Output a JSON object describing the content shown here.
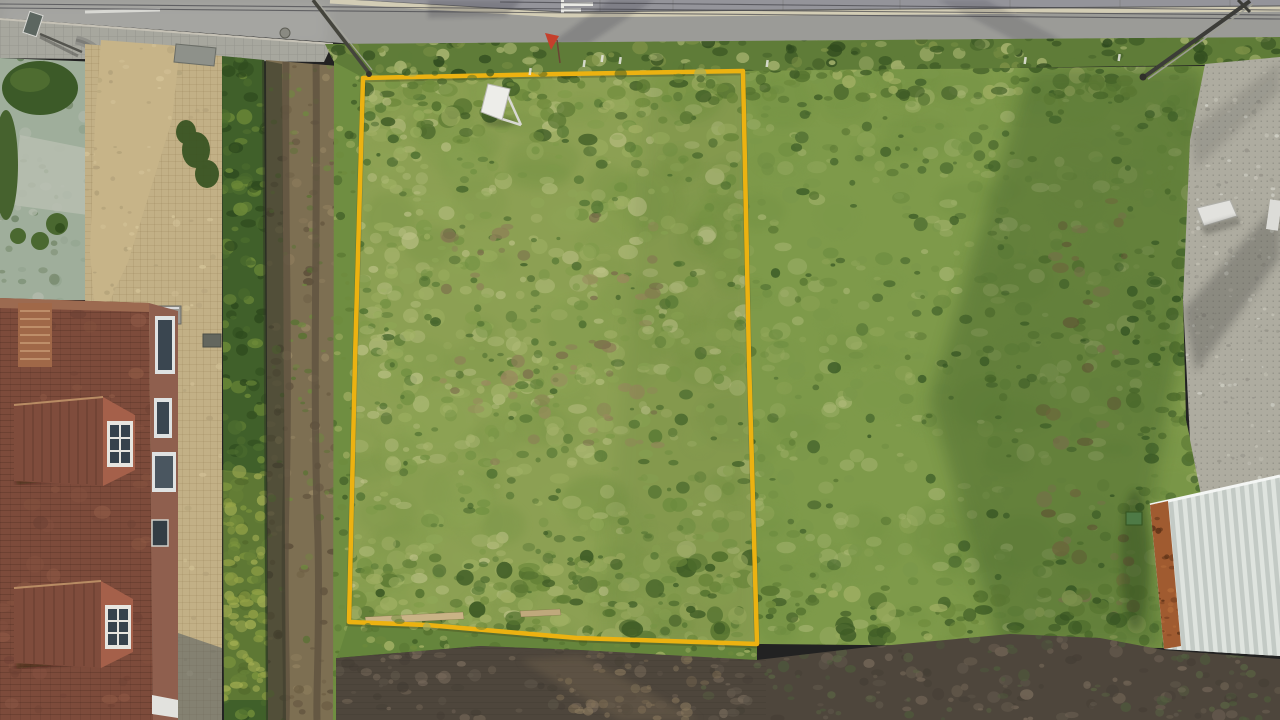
{
  "meta": {
    "type": "aerial-drone-photograph",
    "subject": "grass building plot outlined with a yellow boundary, road at top, house with red tiled roof at left, neighbouring grass field and white barn roof at right, dark ploughed field at bottom",
    "visible_text": "none"
  },
  "palette": {
    "boundary": "#ECB211",
    "asphalt": "#9B9B97",
    "far_sidewalk": "#94949A",
    "curb": "#D3CDB5",
    "sidewalk": "#A7A79E",
    "verge": "#5F7C38",
    "parcel": "#8CA053",
    "neighbor": "#7E9A4A",
    "hedge": "#40602A",
    "hedge_shadow": "#2F3524",
    "track": "#7D6F52",
    "grass_strip": "#6F8E41",
    "garden": "#9FAE9B",
    "garden_hedge": "#3C5A28",
    "driveway": "#C7B488",
    "courtyard": "#C2B086",
    "roof": "#7D4B3B",
    "roof_lit": "#A06848",
    "facade": "#8F5F4E",
    "field": "#4E463C",
    "field_verge": "#65853C",
    "pavers": "#AEACA0",
    "barn_roof": "#D0D5D0",
    "barn_rust": "#A05B30",
    "flag": "#C5402C",
    "sign": "#EDEDE9",
    "window_glass": "#36424C",
    "window_frame": "#E7E5DF",
    "parcel_light": [
      "#B6BF7F",
      "#A9B56E",
      "#C3C68E",
      "#9FB163"
    ],
    "parcel_mid": [
      "#7D9A48",
      "#8FA757",
      "#6F8F40"
    ],
    "parcel_dark": [
      "#4E7030",
      "#42622A",
      "#5A7A36"
    ],
    "parcel_brown": [
      "#8D7F57",
      "#9A8A5E",
      "#7C6F4C"
    ],
    "scrub": [
      "#3F5C26",
      "#6E8A3C",
      "#9FAE62",
      "#567430"
    ],
    "neighbor_light": [
      "#A8B671",
      "#97AA5E",
      "#B4BE7E"
    ],
    "neighbor_mid": [
      "#7A974A",
      "#6D8C40"
    ],
    "neighbor_dark": [
      "#45652C",
      "#3A5A26",
      "#54722F"
    ],
    "trail_brown": [
      "#8B6F4A",
      "#77603F",
      "#96825C"
    ],
    "verge_tones": [
      "#3F5C26",
      "#7D9146",
      "#A8B470",
      "#5F7C38",
      "#2F4A1E"
    ],
    "hedge_tones": [
      "#2E4A1E",
      "#4C6C2E",
      "#6D8A38"
    ],
    "hedge_lit": [
      "#93A246",
      "#A8B258"
    ],
    "track_tones": [
      "#6B5C42",
      "#8D7C5C",
      "#9B8A66",
      "#5A4C38"
    ],
    "track_green": [
      "#6E8A3E",
      "#55732F"
    ],
    "field_tones": [
      "#5F564A",
      "#6D6152",
      "#463F36",
      "#77695A"
    ],
    "field_green": [
      "#5A6644",
      "#4E5C3C"
    ],
    "field_light": [
      "#7B6B52",
      "#8A795E"
    ],
    "paver_specks": [
      "#C2C0B4",
      "#96948A",
      "#D0D0C6"
    ],
    "garden_tones": [
      "#8FA08A",
      "#B5BCAE",
      "#6D8060",
      "#55704A"
    ],
    "roof_blotch": [
      "#96604A",
      "#6B3F33",
      "#8A5542"
    ],
    "courtyard_specks": [
      "#D6C59A",
      "#B09F78"
    ],
    "rust_specks": [
      "#7C4322",
      "#B06A38",
      "#5E3318"
    ]
  }
}
